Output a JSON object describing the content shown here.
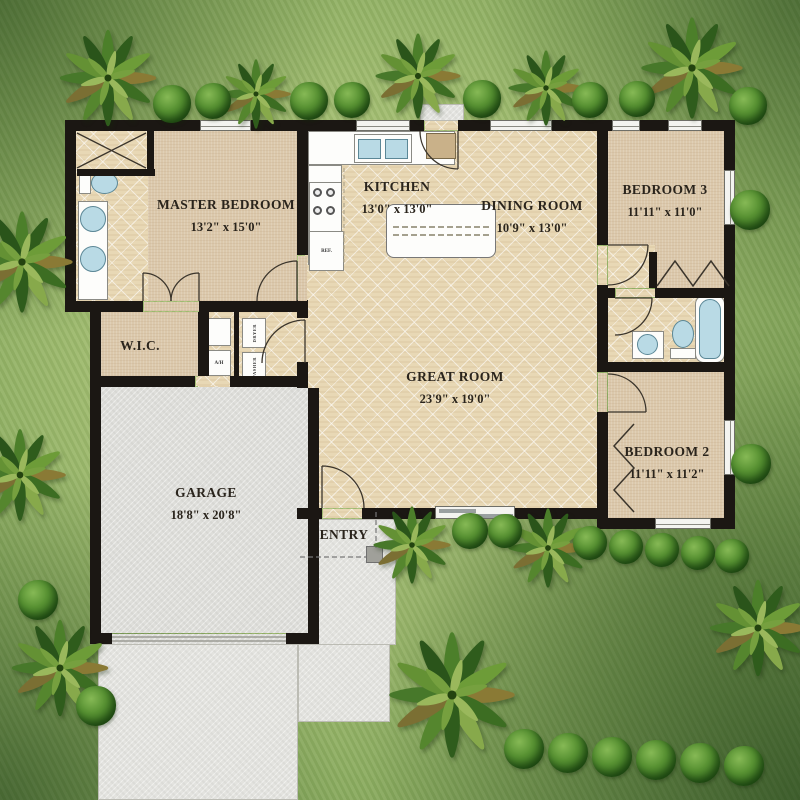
{
  "plan": {
    "rooms": {
      "master_bedroom": {
        "name": "MASTER BEDROOM",
        "dims": "13'2\" x 15'0\""
      },
      "kitchen": {
        "name": "KITCHEN",
        "dims": "13'0\" x 13'0\""
      },
      "dining_room": {
        "name": "DINING ROOM",
        "dims": "10'9\" x 13'0\""
      },
      "great_room": {
        "name": "GREAT ROOM",
        "dims": "23'9\" x 19'0\""
      },
      "bedroom_3": {
        "name": "BEDROOM 3",
        "dims": "11'11\" x 11'0\""
      },
      "bedroom_2": {
        "name": "BEDROOM 2",
        "dims": "11'11\" x 11'2\""
      },
      "wic": {
        "name": "W.I.C."
      },
      "garage": {
        "name": "GARAGE",
        "dims": "18'8\" x 20'8\""
      },
      "entry": {
        "name": "ENTRY"
      }
    },
    "appliances": {
      "refrigerator": "REF.",
      "dishwasher": "DW",
      "air_handler": "A/H",
      "washer": "WASHER",
      "dryer": "DRYER"
    }
  },
  "icons": [
    "palm-tree-icon",
    "bush-icon",
    "shower-icon",
    "toilet-icon",
    "vanity-sink-icon",
    "double-sink-icon",
    "bathtub-icon",
    "range-icon",
    "refrigerator-icon",
    "washer-icon",
    "dryer-icon",
    "kitchen-island-icon",
    "door-swing-arc",
    "bifold-door-icon",
    "window-icon",
    "sliding-glass-door-icon"
  ],
  "colors": {
    "wall": "#1b1713",
    "tile_floor": "#e8d8b5",
    "carpet": "#dbc8ab",
    "concrete": "#e3e3df",
    "grass_base": "#a2bd71",
    "fixture_blue": "#b9dae5",
    "label_text": "#2a241c"
  }
}
